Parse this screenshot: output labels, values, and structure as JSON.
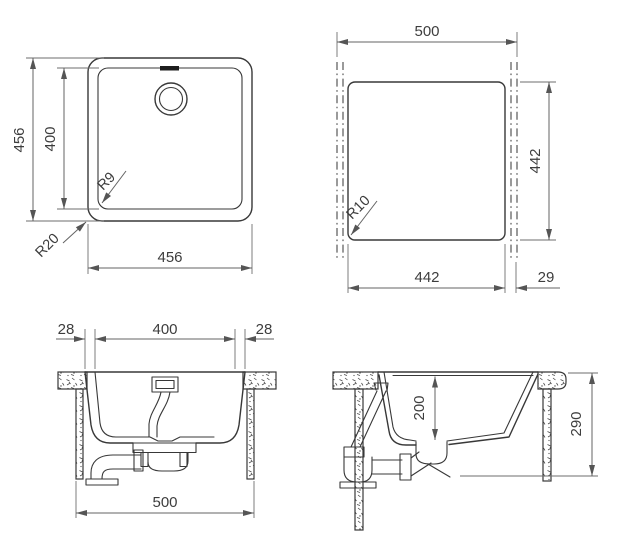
{
  "drawing": {
    "kind": "sink installation technical drawing",
    "colors": {
      "line": "#383838",
      "dimension": "#636363",
      "background": "#ffffff"
    },
    "views": {
      "plan": {
        "height": "456",
        "bowl_height": "400",
        "bowl_corner_radius": "R9",
        "outer_corner_radius": "R20",
        "width": "456"
      },
      "cutout": {
        "width": "500",
        "height": "442",
        "corner_radius": "R10",
        "cutout_width": "442",
        "edge_offset": "29"
      },
      "front_section": {
        "left_offset": "28",
        "bowl_width": "400",
        "right_offset": "28",
        "cabinet_width": "500"
      },
      "side_section": {
        "bowl_depth": "200",
        "overall_depth": "290"
      }
    }
  }
}
